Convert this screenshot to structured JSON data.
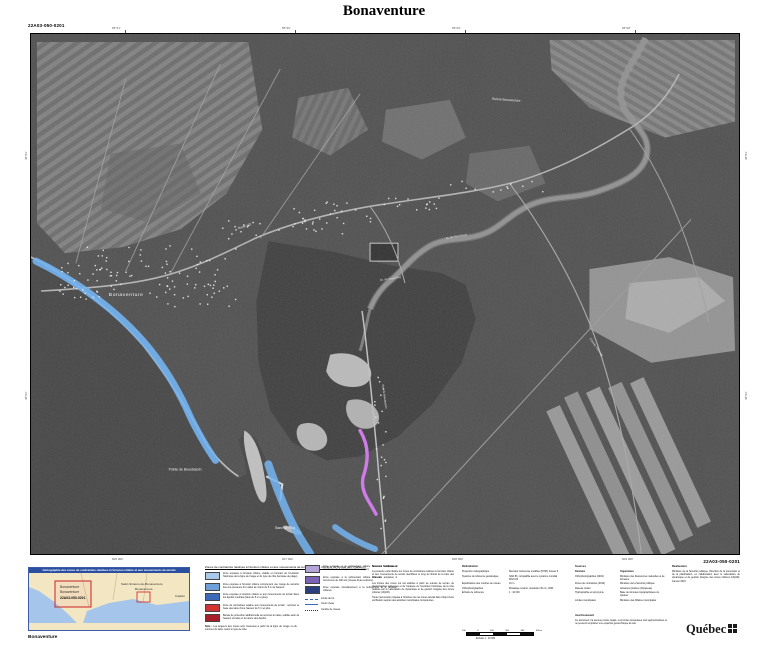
{
  "sheet": {
    "title": "Bonaventure",
    "code": "22A03-050-0201",
    "caption": "Bonaventure"
  },
  "colors": {
    "erosion_zone_blue": "#74b4f0",
    "submersion_zone_magenta": "#cf7ce8",
    "locator_header_blue": "#2b4fa0",
    "locator_red": "#cc3333"
  },
  "map": {
    "labels": {
      "town": "Bonaventure",
      "pointe": "Pointe de Beaubassin",
      "banc": "Banc de l'Est",
      "riviere": "Rivière Bonaventure",
      "route132": "Route 132",
      "grand_pre": "Av. de Grand-Pré",
      "port_royal": "Av. de Port-Royal",
      "beaubassin": "Rue de Beaubassin",
      "thivierge": "Chemin Thivierge"
    },
    "ticks": {
      "top": [
        "65°31'",
        "65°30'",
        "65°29'",
        "65°28'"
      ],
      "bottom": [
        "606 000",
        "607 000",
        "608 000",
        "609 000"
      ],
      "left": [
        "48°03'",
        "48°02'"
      ],
      "right": [
        "48°03'",
        "48°02'"
      ]
    }
  },
  "locator": {
    "title": "Cartographie des zones de contraintes relatives à l'érosion côtière et aux mouvements de terrain",
    "sheet_line1": "Bonaventure",
    "sheet_line2": "Bonaventure",
    "sheet_code": "22A03-050-0201",
    "label_east": "Saint-Siméon-de-Bonaventure",
    "label_east2": "Bonaventure",
    "label_far": "Caplan"
  },
  "legend": {
    "heading": "Zones de contraintes relatives à l'érosion côtière et aux mouvements de terrain (bande riveraine de la baie des Chaleurs)",
    "col1": [
      {
        "color": "#aac8e8",
        "text": "Zone exposée à l'érosion côtière, établie en fonction de l'évolution historique de la ligne de rivage et du type de côte (terrasse de plage)."
      },
      {
        "color": "#6f9fd8",
        "text": "Zone exposée à l'érosion côtière comprenant une marge de sécurité liée à la présence d'un talus de moins de 5 m de hauteur."
      },
      {
        "color": "#3a6ab8",
        "text": "Zone exposée à l'érosion côtière et aux mouvements de terrain dans les dépôts meubles (talus de 5 m et plus)."
      },
      {
        "color": "#d23333",
        "text": "Zone de contraintes relative aux mouvements de terrain : sommet et base des talus d'une hauteur de 5 m et plus."
      },
      {
        "color": "#a81f2a",
        "text": "Bande de protection additionnelle au sommet du talus, établie selon la hauteur du talus et la nature des dépôts."
      }
    ],
    "col2": [
      {
        "color": "#b4a4d8",
        "text": "Zone exposée à la submersion côtière lors des tempêtes à récurrence de 2 ans (niveau d'eau moyen)."
      },
      {
        "color": "#7c64b4",
        "text": "Zone exposée à la submersion côtière lors des tempêtes à récurrence de 100 ans (niveau d'eau extrême)."
      },
      {
        "color": "#2a3f7e",
        "text": "Zone exposée simultanément à la submersion et à l'érosion côtières."
      }
    ],
    "lines": [
      {
        "label": "Limite de lot"
      },
      {
        "label": "Cours d'eau"
      },
      {
        "label": "Courbe de niveau"
      }
    ],
    "note_label": "Note :",
    "note": "Les largeurs des zones sont mesurées à partir de la ligne de rivage ou du sommet du talus, selon le type de côte."
  },
  "notes": {
    "heading": "Notes à l'utilisateur",
    "p1": "La présente carte illustre les zones de contraintes relatives à l'érosion côtière et aux mouvements de terrain identifiées le long du littoral de la baie des Chaleurs.",
    "p2": "Les limites des zones ont été établies à partir de relevés de terrain, de photographies aériennes et de l'analyse de l'évolution historique de la côte réalisée par le Laboratoire de dynamique et de gestion intégrée des zones côtières (UQAR).",
    "p3": "Toute intervention projetée à l'intérieur de ces zones devrait faire l'objet d'une vérification auprès des autorités municipales compétentes."
  },
  "delimitation": {
    "heading": "Délimitation",
    "rows": [
      [
        "Projection cartographique",
        "Mercator transverse modifiée (MTM), fuseau 5"
      ],
      [
        "Système de référence géodésique",
        "NAD 83, compatible avec le système mondial WGS 84"
      ],
      [
        "Équidistance des courbes de niveau",
        "10 m"
      ],
      [
        "Orthophotographies",
        "Mosaïque couleur, résolution 30 cm, 2004"
      ],
      [
        "Échelle de référence",
        "1 : 10 000"
      ]
    ],
    "scale_ticks": [
      "100",
      "0",
      "100",
      "200",
      "300",
      "400 m"
    ],
    "scale_caption": "Échelle 1 : 10 000"
  },
  "sources": {
    "heading": "Sources",
    "col_data": "Données",
    "col_org": "Organismes",
    "rows": [
      [
        "Orthophotographies (2004)",
        "Ministère des Ressources naturelles et de la Faune"
      ],
      [
        "Zones de contraintes (2016)",
        "Ministère de la Sécurité publique"
      ],
      [
        "Réseau routier",
        "Adresses Québec (AQréseau)"
      ],
      [
        "Hydrographie et toponymie",
        "Base de données topographiques du Québec"
      ],
      [
        "Limites municipales",
        "Ministère des Affaires municipales"
      ]
    ]
  },
  "avertissement": {
    "heading": "Avertissement",
    "text": "Ce document n'a aucune portée légale. Les limites présentées sont approximatives et ne peuvent remplacer une expertise géotechnique de site."
  },
  "realisation": {
    "heading": "Réalisation",
    "text": "Ministère de la Sécurité publique, Direction de la prévention et de la planification, en collaboration avec le Laboratoire de dynamique et de gestion intégrée des zones côtières (UQAR). Janvier 2016."
  },
  "footer": {
    "logo": "Québec"
  }
}
